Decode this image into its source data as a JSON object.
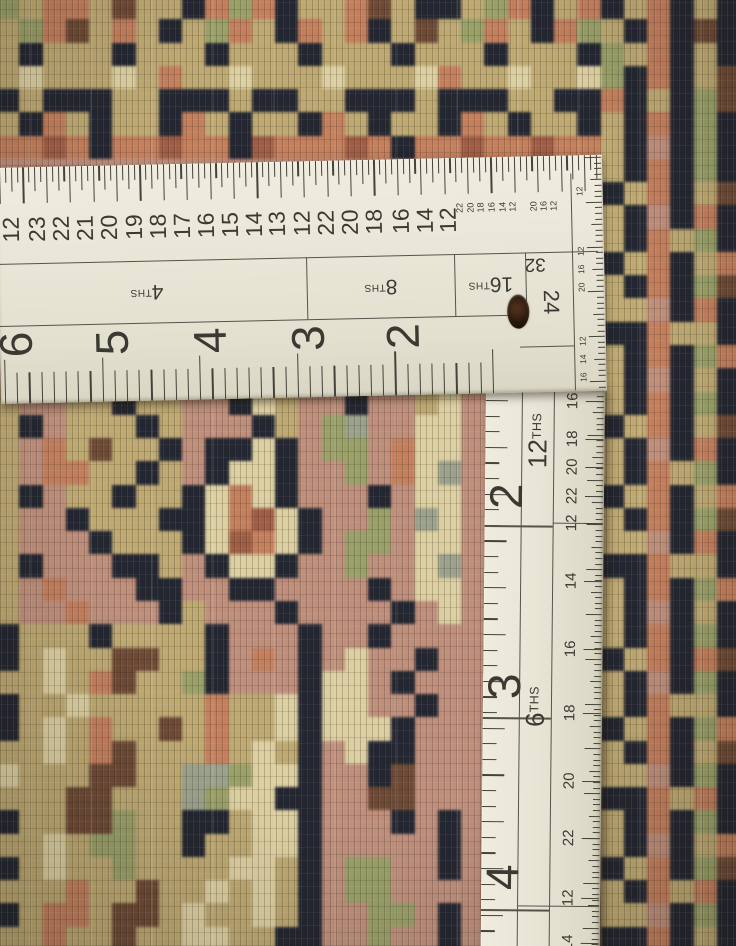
{
  "rug": {
    "palette": {
      "n": "#232733",
      "k": "#bfa970",
      "c": "#ddcf9f",
      "g": "#99a066",
      "m": "#9aa18b",
      "r": "#c18f7b",
      "s": "#c67e5b",
      "t": "#a25c43",
      "b": "#6f4a35"
    },
    "grid_cols": 32,
    "rows": [
      "gksskbkknsgsnkksbknnkgsnksnksnkn",
      "kgsbksknkgsknsksnkbkgsknsgknsnbn",
      "knkkknkkknkkknkkknkkknkkkngksnkn",
      "kckkkckskkckkkckkkcskkckkcgnsnkb",
      "nknnnkknnnknnkknnnknnnkknnsnkngb",
      "knsknkknsknkknsknkknsknkknknsngn",
      "sstsnsstssntssstsnsstsstssknrngn",
      "rrrrrrrrrrrrrrrrrrrrrrrrrrknsngn",
      "rrrrrrrrrrrrrrrrrrrrrrrrrrnksnkb",
      "rrrrrrrrrrrrrrrrrrrrrrrrrrknrnsn",
      "rrrrrrrrrrrrrrrrrrrrrrrrrrknskgn",
      "rrrrrrrrrrrrrrrrrrrrrrrrrrnksnks",
      "rrrrrrrrrrrrrrrrrrrrrrrrrrknsngb",
      "rrrrrrrrrrrrrrrrrrrrrrrrrrkkrnsn",
      "rrrrrrrrrrrrrrrrrrrrrrrrrrnnskkn",
      "rrrrrrrrrrrrrrrrrrrrrrrrrrknsngs",
      "rrrrrrrrrrrrrrrrrrrrrrrrrrknrnkn",
      "krrkknkkrrnckrrnrrkcrrrrrrknsngn",
      "knrkkknkrrrnkrgmrrccrrrrrrnksnkb",
      "krskbkknrnncnrggrsccrrrrrrknrnsn",
      "krsskknkrnccnrrgrscmrrrrrrknskgn",
      "knrkknkkncscnrrrnrccrrrrrrnksnks",
      "krrnkkknncstcnrrgrmcrrrrrrknsngb",
      "krrrnkkknctscnrggrccrrrrrrkkrnsn",
      "knrrrnnkrnccnrrgrrcmrrrrrrnnskkn",
      "krsrrrnnrrnnrrrrnrccrrrrrrknsngs",
      "krrsrrrnkrrrnrrrrnrcrrrrrrknrnkn",
      "nkkknkkkknrrrnrrnrrrrrrrrrknsngn",
      "nkckkbbkknrsrnrcrrnrrrrrrrnksnsb",
      "kkcksbkkgnrrrnccrnrrrrrrrrknrngn",
      "nkkckkkkkskkcnccrrnrrrrrrrknskkn",
      "nkckskkbkskkcncccnrrrrrrrrnksngs",
      "kkcksbkkkskcknrcnnrrrrrrrrknsnkb",
      "ckkkbbkkmmgccnrrnbrrrrrrrrkkrngn",
      "kkkbbkkkmgccnnrrbbrrrrrrrrnnsksn",
      "nkkbbgkknnkccnrrrnrnrrrrrrknsngn",
      "kkckggkknkkccnrrrrrnrrrrrrknrnks",
      "nkckkgkkkkccknrggrrnrrrrrrnksngb",
      "kkkskkbkkckcknrggrrrrrrrrrknsksn",
      "nksskbbkckkcknrrggrnrrrrrrkkrngn",
      "kkskkbkkcckknnrrgrrnrrrrrrnnsnkn"
    ]
  },
  "ruler": {
    "colors": {
      "face": "#e9e6d7",
      "ink": "#3b3a32",
      "line": "#55544a"
    },
    "horizontal": {
      "top_numbers": [
        {
          "t": "12",
          "x": 14
        },
        {
          "t": "23",
          "x": 40
        },
        {
          "t": "22",
          "x": 64
        },
        {
          "t": "21",
          "x": 88
        },
        {
          "t": "20",
          "x": 112
        },
        {
          "t": "19",
          "x": 137
        },
        {
          "t": "18",
          "x": 161
        },
        {
          "t": "17",
          "x": 185
        },
        {
          "t": "16",
          "x": 209
        },
        {
          "t": "15",
          "x": 233
        },
        {
          "t": "14",
          "x": 257
        },
        {
          "t": "13",
          "x": 280
        },
        {
          "t": "12",
          "x": 305
        },
        {
          "t": "22",
          "x": 329
        },
        {
          "t": "20",
          "x": 353
        },
        {
          "t": "18",
          "x": 377
        },
        {
          "t": "16",
          "x": 404
        },
        {
          "t": "14",
          "x": 428
        },
        {
          "t": "12",
          "x": 451
        }
      ],
      "top_tiny_numbers": [
        {
          "t": "22",
          "x": 463
        },
        {
          "t": "20",
          "x": 474
        },
        {
          "t": "18",
          "x": 484
        },
        {
          "t": "16",
          "x": 495
        },
        {
          "t": "14",
          "x": 506
        },
        {
          "t": "12",
          "x": 516
        },
        {
          "t": "20",
          "x": 537
        },
        {
          "t": "16",
          "x": 547
        },
        {
          "t": "12",
          "x": 557
        }
      ],
      "band_labels": [
        {
          "num": "4",
          "sup": "THS",
          "x": 148
        },
        {
          "num": "8",
          "sup": "THS",
          "x": 382
        },
        {
          "num": "16",
          "sup": "THS",
          "x": 492
        }
      ],
      "corner_label_32": "32",
      "corner_label_24": "24",
      "bottom_numbers": [
        {
          "t": "6",
          "x": 16
        },
        {
          "t": "5",
          "x": 112
        },
        {
          "t": "4",
          "x": 210
        },
        {
          "t": "3",
          "x": 308
        },
        {
          "t": "2",
          "x": 403
        }
      ],
      "corner_tiny_numbers": [
        {
          "t": "12",
          "y": 36
        },
        {
          "t": "12",
          "y": 96
        },
        {
          "t": "16",
          "y": 114
        },
        {
          "t": "20",
          "y": 132
        },
        {
          "t": "12",
          "y": 186
        },
        {
          "t": "14",
          "y": 204
        },
        {
          "t": "16",
          "y": 222
        }
      ]
    },
    "vertical": {
      "left_numbers": [
        {
          "t": "2",
          "y": 108
        },
        {
          "t": "3",
          "y": 298
        },
        {
          "t": "4",
          "y": 489
        }
      ],
      "mid_labels": [
        {
          "num": "12",
          "sup": "THS",
          "y": 52
        },
        {
          "num": "6",
          "sup": "THS",
          "y": 318
        }
      ],
      "right_numbers": [
        {
          "t": "16",
          "y": 12
        },
        {
          "t": "18",
          "y": 50
        },
        {
          "t": "20",
          "y": 78
        },
        {
          "t": "22",
          "y": 107
        },
        {
          "t": "12",
          "y": 134
        },
        {
          "t": "14",
          "y": 192
        },
        {
          "t": "16",
          "y": 260
        },
        {
          "t": "18",
          "y": 324
        },
        {
          "t": "20",
          "y": 392
        },
        {
          "t": "22",
          "y": 449
        },
        {
          "t": "12",
          "y": 509
        },
        {
          "t": "14",
          "y": 554
        }
      ]
    },
    "scales": {
      "top_tick_spacing": 5.85,
      "bottom_tick_spacing": 12.2,
      "left_tick_spacing": 15.6,
      "fine_tick_spacing": 5.6,
      "inch_lines_v": [
        137,
        329,
        521
      ],
      "band_top_y": 96,
      "band_bottom_y": 158,
      "band_dividers_x": [
        308,
        456,
        527
      ]
    }
  }
}
